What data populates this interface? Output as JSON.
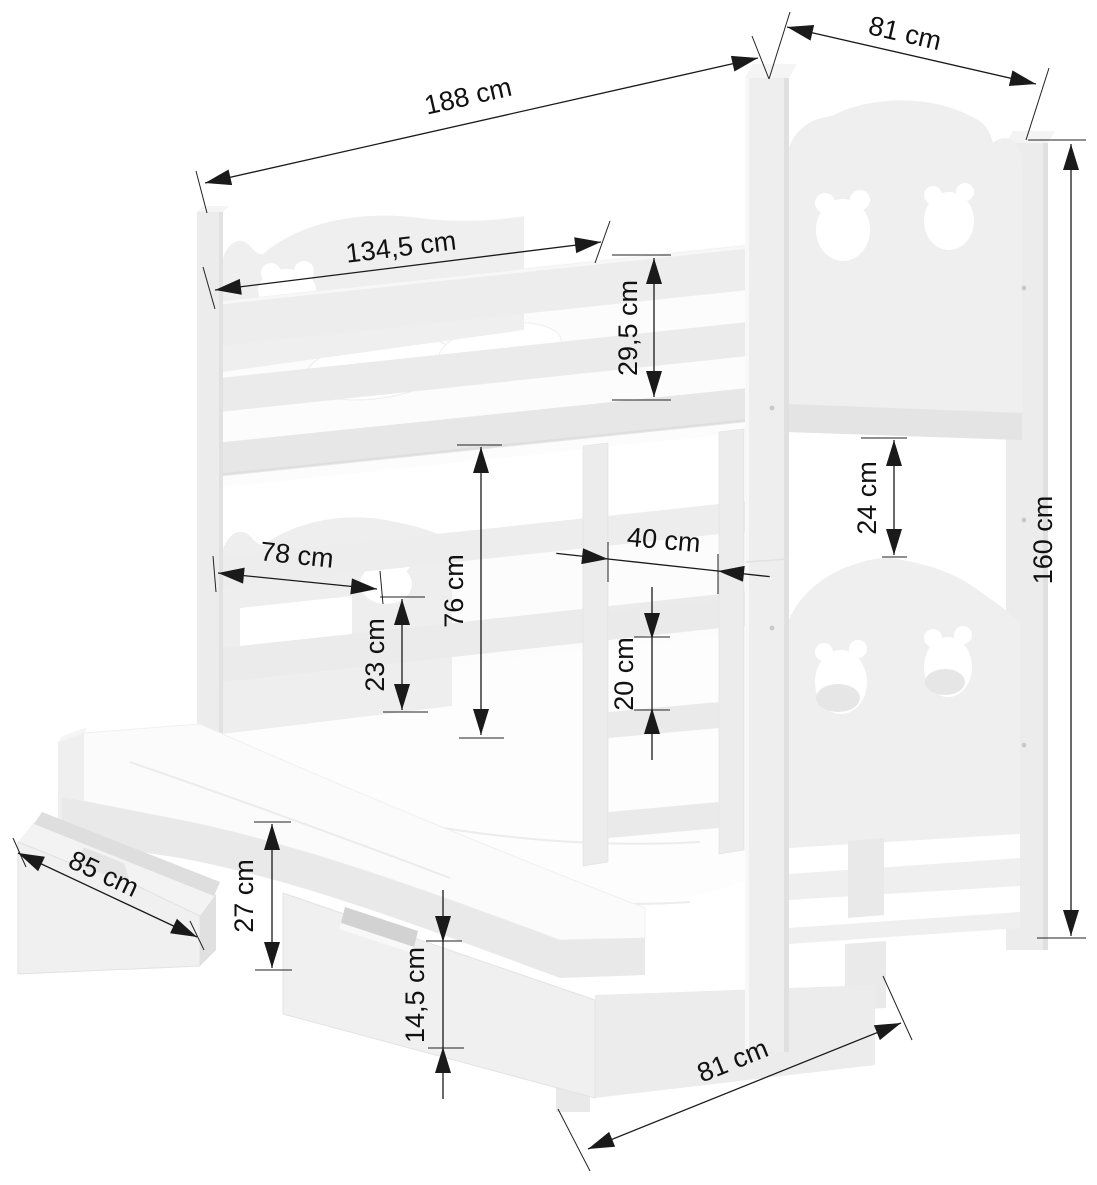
{
  "diagram": {
    "kind": "furniture dimension drawing",
    "subject": "triple bunk bed with pull-out trundle bed, ladder, bear-cutout panels and two storage drawers",
    "unit": "cm",
    "background_color": "#ffffff",
    "annotation_color": "#1a1a1a",
    "bed_fill_color": "#ededed"
  },
  "dims": {
    "total_length": {
      "label": "188 cm",
      "value": 188
    },
    "top_depth": {
      "label": "81 cm",
      "value": 81
    },
    "inner_length": {
      "label": "134,5 cm",
      "value": 134.5
    },
    "guard_rail_height": {
      "label": "29,5 cm",
      "value": 29.5
    },
    "headboard_gap": {
      "label": "24 cm",
      "value": 24
    },
    "total_height": {
      "label": "160 cm",
      "value": 160
    },
    "lower_guard_length": {
      "label": "78 cm",
      "value": 78
    },
    "bunk_clearance": {
      "label": "76 cm",
      "value": 76
    },
    "ladder_width": {
      "label": "40 cm",
      "value": 40
    },
    "lower_guard_height": {
      "label": "23 cm",
      "value": 23
    },
    "rung_spacing": {
      "label": "20 cm",
      "value": 20
    },
    "end_drawer_length": {
      "label": "85 cm",
      "value": 85
    },
    "trundle_height": {
      "label": "27 cm",
      "value": 27
    },
    "drawer_front_height": {
      "label": "14,5 cm",
      "value": 14.5
    },
    "bottom_depth": {
      "label": "81 cm",
      "value": 81
    }
  }
}
